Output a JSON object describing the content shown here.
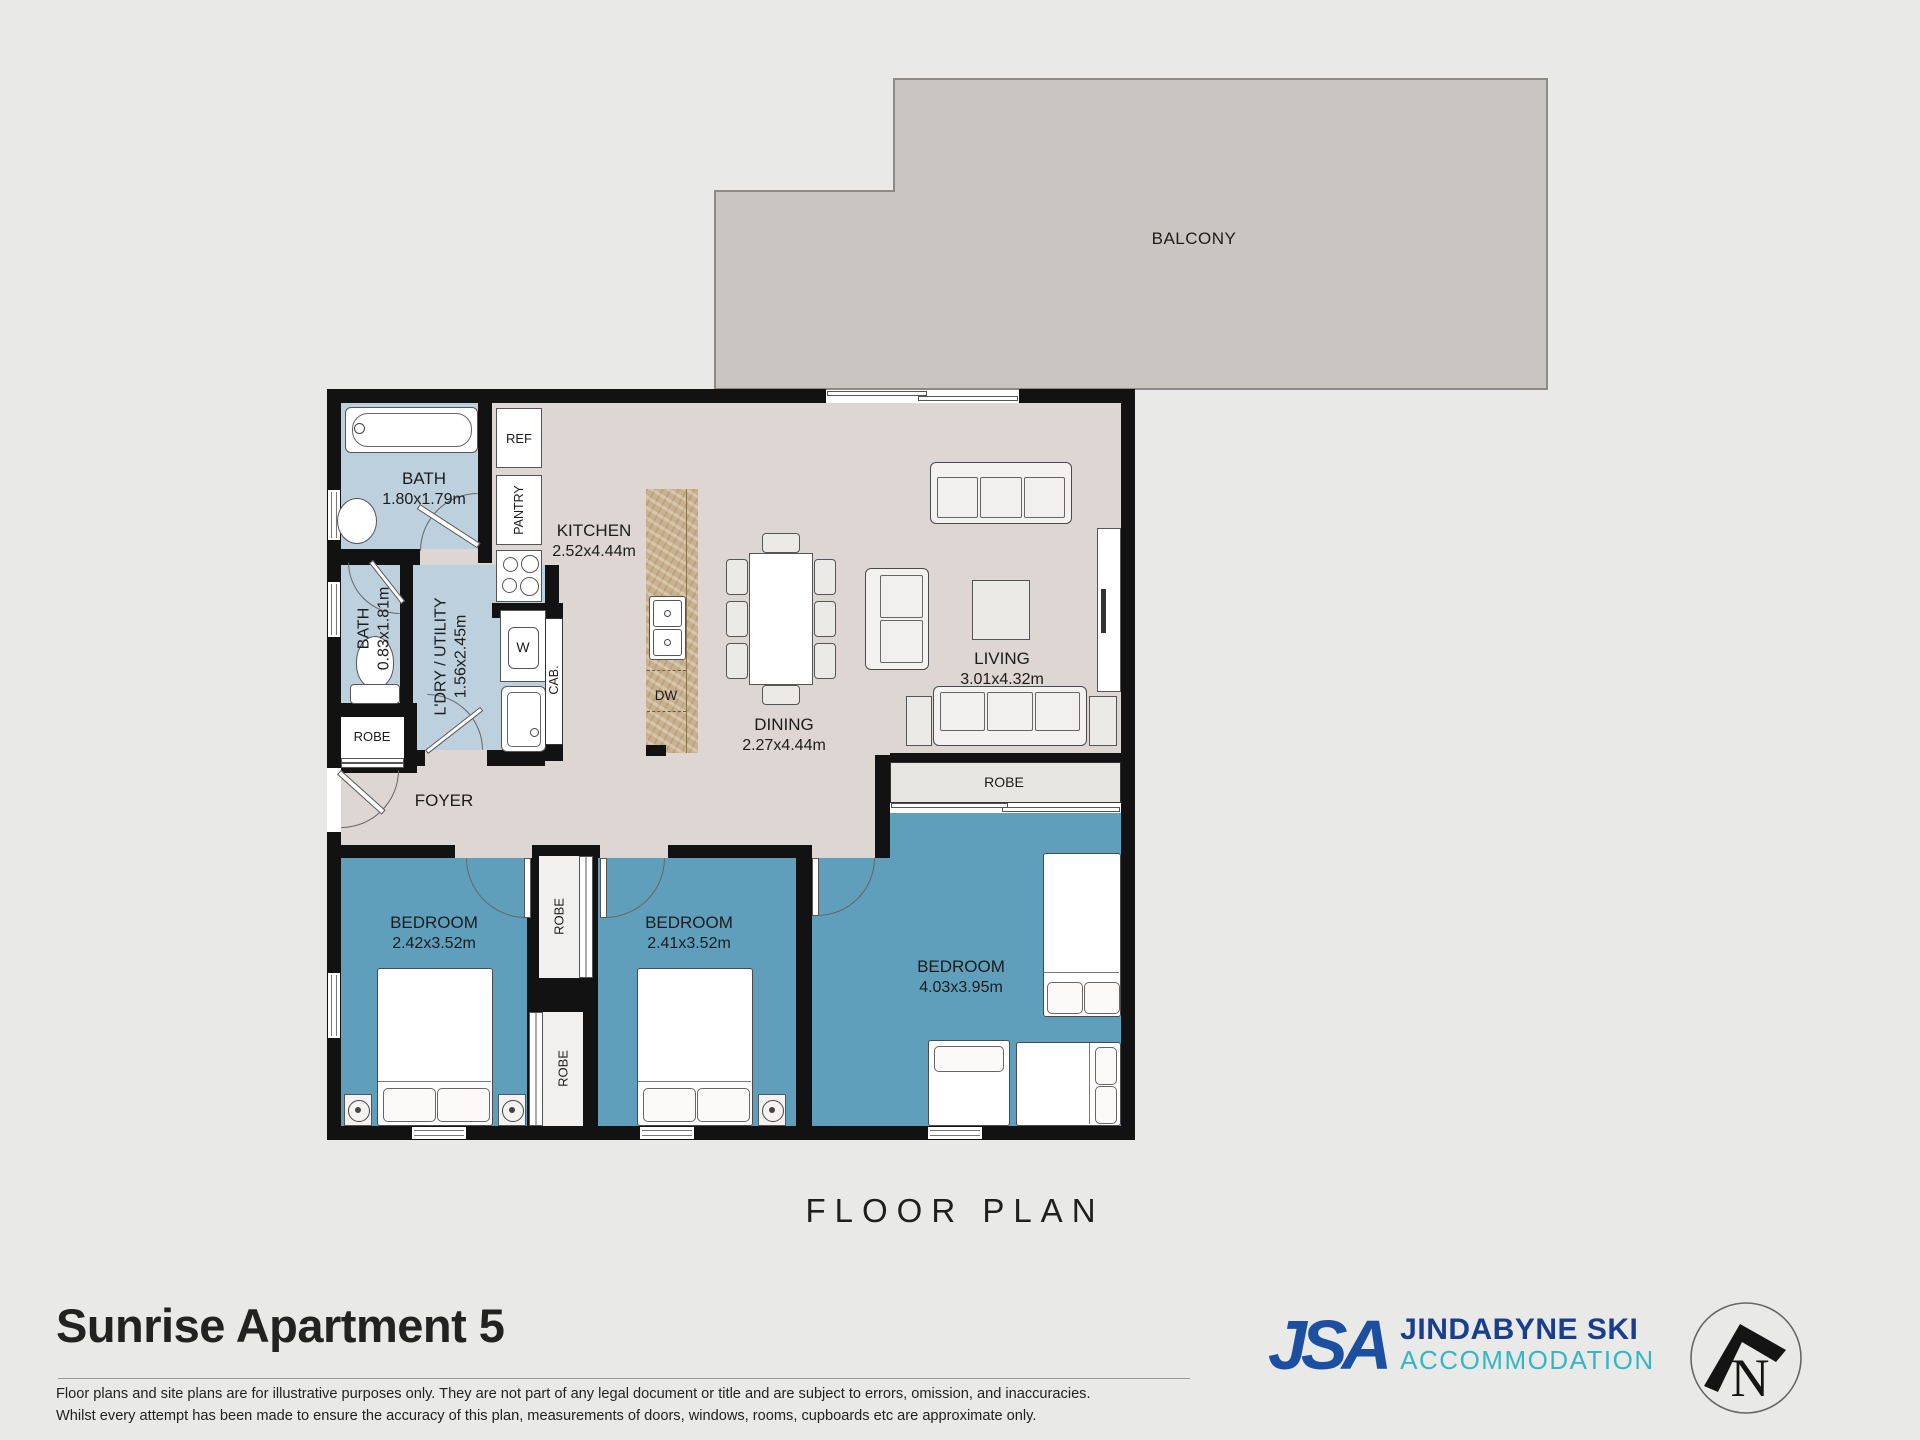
{
  "plan": {
    "balcony_label": "BALCONY",
    "floor_plan_title": "FLOOR PLAN",
    "rooms": {
      "bath1": {
        "name": "BATH",
        "dims": "1.80x1.79m"
      },
      "bath2": {
        "name": "BATH",
        "dims": "0.83x1.81m"
      },
      "laundry": {
        "name": "L'DRY / UTILITY",
        "dims": "1.56x2.45m"
      },
      "kitchen": {
        "name": "KITCHEN",
        "dims": "2.52x4.44m"
      },
      "dining": {
        "name": "DINING",
        "dims": "2.27x4.44m"
      },
      "living": {
        "name": "LIVING",
        "dims": "3.01x4.32m"
      },
      "foyer": {
        "name": "FOYER"
      },
      "bedroom1": {
        "name": "BEDROOM",
        "dims": "2.42x3.52m"
      },
      "bedroom2": {
        "name": "BEDROOM",
        "dims": "2.41x3.52m"
      },
      "bedroom3": {
        "name": "BEDROOM",
        "dims": "4.03x3.95m"
      }
    },
    "fixtures": {
      "ref": "REF",
      "pantry": "PANTRY",
      "cab": "CAB.",
      "washer": "W",
      "dishwasher": "DW",
      "robe": "ROBE"
    }
  },
  "footer": {
    "title": "Sunrise Apartment 5",
    "disclaimer_line1": "Floor plans and site plans are for illustrative purposes only. They are not part of any legal document or title and are subject to errors, omission, and inaccuracies.",
    "disclaimer_line2": "Whilst every attempt has been made to ensure the accuracy of this plan, measurements of doors, windows, rooms, cupboards etc are approximate only."
  },
  "logo": {
    "initials": "JSA",
    "line1": "JINDABYNE SKI",
    "line2": "ACCOMMODATION"
  },
  "compass": {
    "letter": "N"
  },
  "colors": {
    "page_bg": "#e9e9e8",
    "balcony": "#c9c6c1",
    "floor": "#ddd6d2",
    "wet_rooms": "#bdd0de",
    "bedrooms": "#5f9fbc",
    "walls": "#121212",
    "island": "#c9b190",
    "logo_blue": "#1d4fa0",
    "logo_navy": "#1a3e8e",
    "logo_teal": "#35b6c5"
  }
}
